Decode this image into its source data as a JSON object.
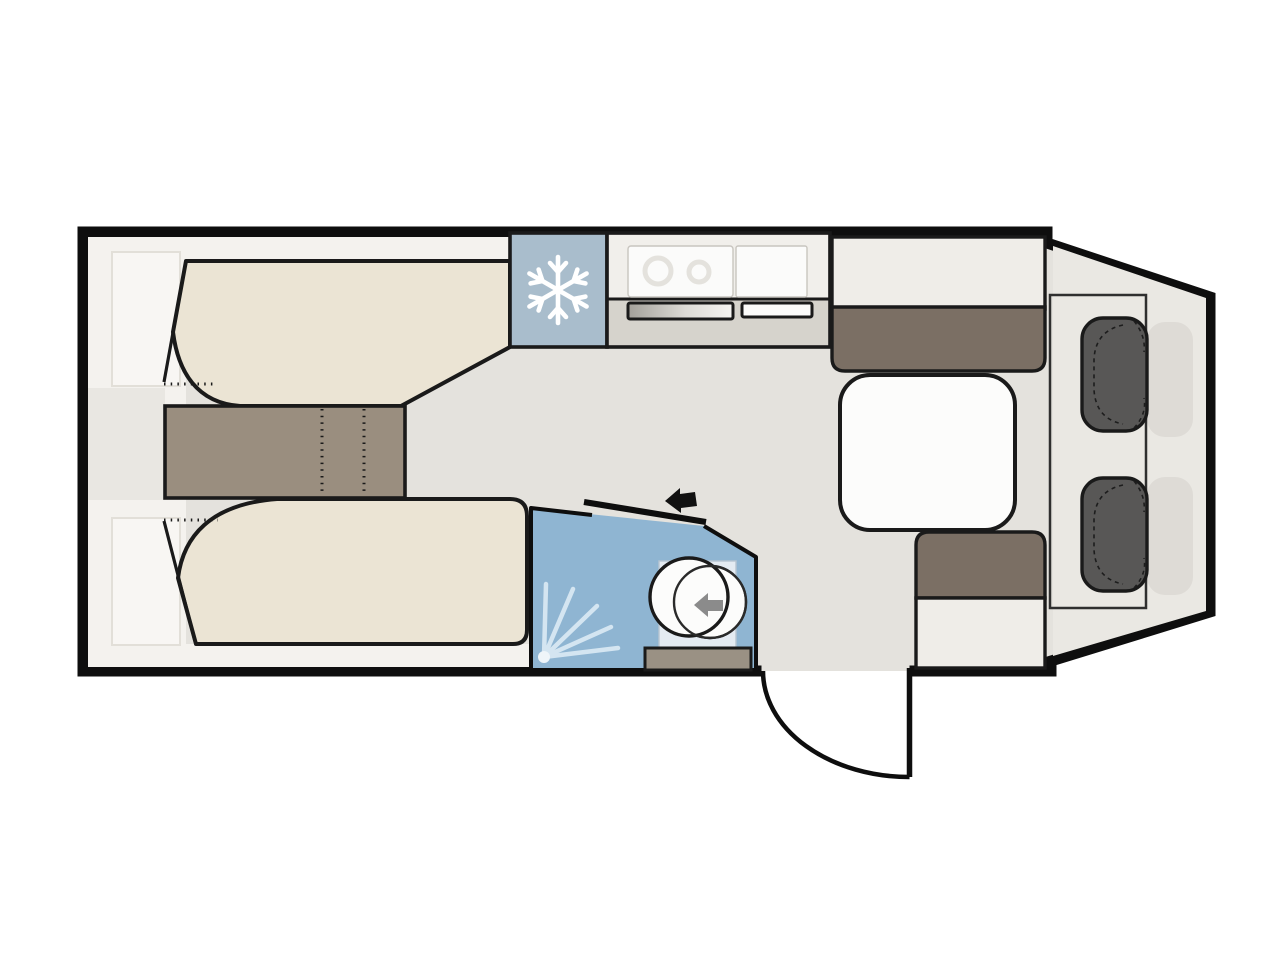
{
  "window": {
    "background": "#ffffff"
  },
  "floorplan": {
    "type": "caravan-floor-plan",
    "colors": {
      "page": "#ffffff",
      "wall": "#0e0e0e",
      "outline": "#1a1a1a",
      "floor": "#e4e2dd",
      "cab_floor": "#eae8e3",
      "strip": "#f4f2ee",
      "band": "#e9e7e2",
      "faint_fill": "#f8f6f3",
      "faint_stroke": "#e2dfd8",
      "bed": "#ebe4d4",
      "chest": "#9a8e7f",
      "backrest": "#7b6f64",
      "seat": "#efede8",
      "table_white": "#fcfcfb",
      "fridge_blue": "#a9bdcc",
      "bathroom_blue": "#8fb5d2",
      "shower_tray": "#e4ebf2",
      "counter_top": "#f1efeb",
      "counter_base": "#d6d3cc",
      "appliance_white": "#fbfbfa",
      "burner": "#dcd9d3",
      "toilet_base": "#9a9184",
      "cab_seat": "#585756",
      "seat_shadow": "#dedbd6",
      "ray": "#d4e5f1",
      "spray_dot": "#eff5f9",
      "arrow_gray": "#8b8b8b",
      "arrow_black": "#111111"
    },
    "icons": {
      "fridge_icon": "snowflake-icon",
      "shower_icon": "shower-spray-icon",
      "toilet_icon": "swivel-left-arrow-icon",
      "sliding_door_icon": "slide-left-arrow-icon",
      "entry_door_icon": "door-swing-arc"
    }
  }
}
